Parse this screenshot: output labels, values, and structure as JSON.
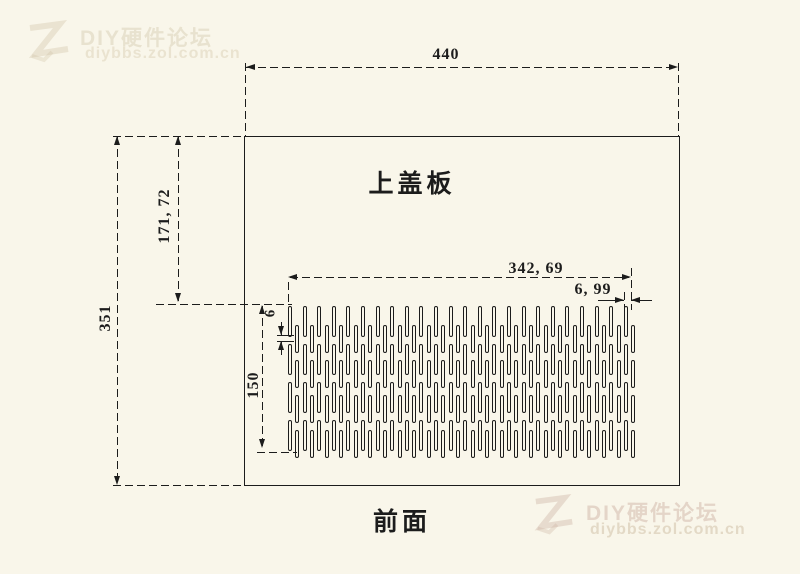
{
  "watermark": {
    "brand": "DIY硬件论坛",
    "url": "diybbs.zol.com.cn"
  },
  "drawing": {
    "part_label": "上盖板",
    "view_label": "前面",
    "dimensions": {
      "overall_width": "440",
      "overall_height": "351",
      "top_offset": "171, 72",
      "slot_area_width": "342, 69",
      "slot_pitch": "6, 99",
      "slot_gap": "6",
      "slot_area_height": "150"
    },
    "slot_field": {
      "columns": 48,
      "x_start": 288,
      "pitch": 7.3,
      "slot_width": 4,
      "phase_a": {
        "tops": [
          306,
          344,
          382,
          420
        ],
        "height": 31
      },
      "phase_b": {
        "tops": [
          325,
          360,
          395,
          430
        ],
        "height": 28
      }
    },
    "colors": {
      "background": "#F9F6EA",
      "line": "#1C1C1C"
    }
  }
}
